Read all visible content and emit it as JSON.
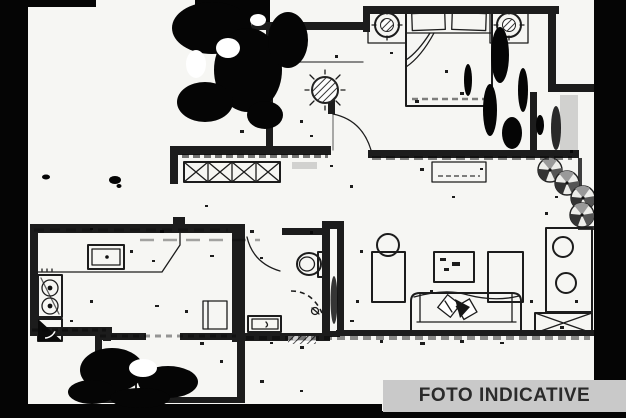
{
  "banner": {
    "label": "FOTO INDICATIVE"
  },
  "colors": {
    "paper": "#f6f6f3",
    "ink": "#1c1c1c",
    "noise": "#050505",
    "banner_bg": "#c9c9c9",
    "banner_text": "#2b2b2b",
    "smudge": "#8d8d8d"
  },
  "plan": {
    "type": "apartment-floor-plan-scan",
    "rooms": [
      "bedroom",
      "hallway",
      "kitchen",
      "bathroom",
      "living-room",
      "utility-room",
      "terrace"
    ],
    "furniture_icons": [
      "double-bed-icon",
      "pillow-icon",
      "bedside-lamp-icon",
      "potted-plant-icon",
      "door-arc-icon",
      "window-cross-icon",
      "kitchen-counter-icon",
      "kitchen-sink-icon",
      "cooktop-icon",
      "corner-cabinet-icon",
      "toilet-icon",
      "washbasin-icon",
      "shower-icon",
      "sofa-icon",
      "cushion-icon",
      "tv-table-icon",
      "sideboard-icon",
      "console-stools-icon",
      "radiator-window-icon",
      "washing-machine-icon",
      "terrace-plant-icon"
    ]
  }
}
